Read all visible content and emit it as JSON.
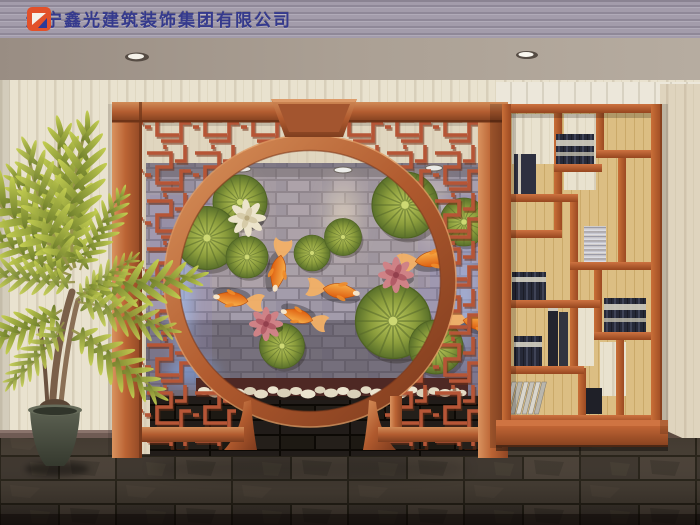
{
  "watermark": {
    "company_name": "辽宁鑫光建筑装饰集团有限公司",
    "text_color": "#353a8d",
    "logo": {
      "name": "xinguang-logo",
      "primary": "#e2512a",
      "secondary": "#2c3a9a",
      "accent": "#f4f1ea"
    }
  },
  "scene": {
    "style": "chinese-interior-3d-render",
    "objects": {
      "moon_gate": {
        "label": "moon-gate-lattice-screen",
        "wood_color": "#b4592e",
        "lattice_color": "#b65536"
      },
      "feature_wall": {
        "label": "koi-lotus-brick-wall",
        "brick_color": "#9a93a1",
        "accent_glow": "#9cc0f4",
        "koi_count": 6,
        "lotus_leaf_count": 10,
        "lotus_flower_count": 3,
        "spotlight_count": 3
      },
      "display_shelf": {
        "label": "wooden-bogu-shelf",
        "wood_color": "#b05327",
        "back_color": "#dcbe83",
        "book_stacks": 7
      },
      "potted_plant": {
        "label": "palm-plant",
        "pot_color": "#474b3e",
        "foliage_color": "#9aa83c"
      },
      "floor": {
        "label": "dark-slate-tile-floor",
        "color": "#332b24"
      },
      "ceiling": {
        "label": "ceiling-with-downlights",
        "downlight_count": 2
      },
      "pebble_strip": {
        "label": "white-pebble-border",
        "pebble_color": "#e8e0cb"
      }
    }
  }
}
